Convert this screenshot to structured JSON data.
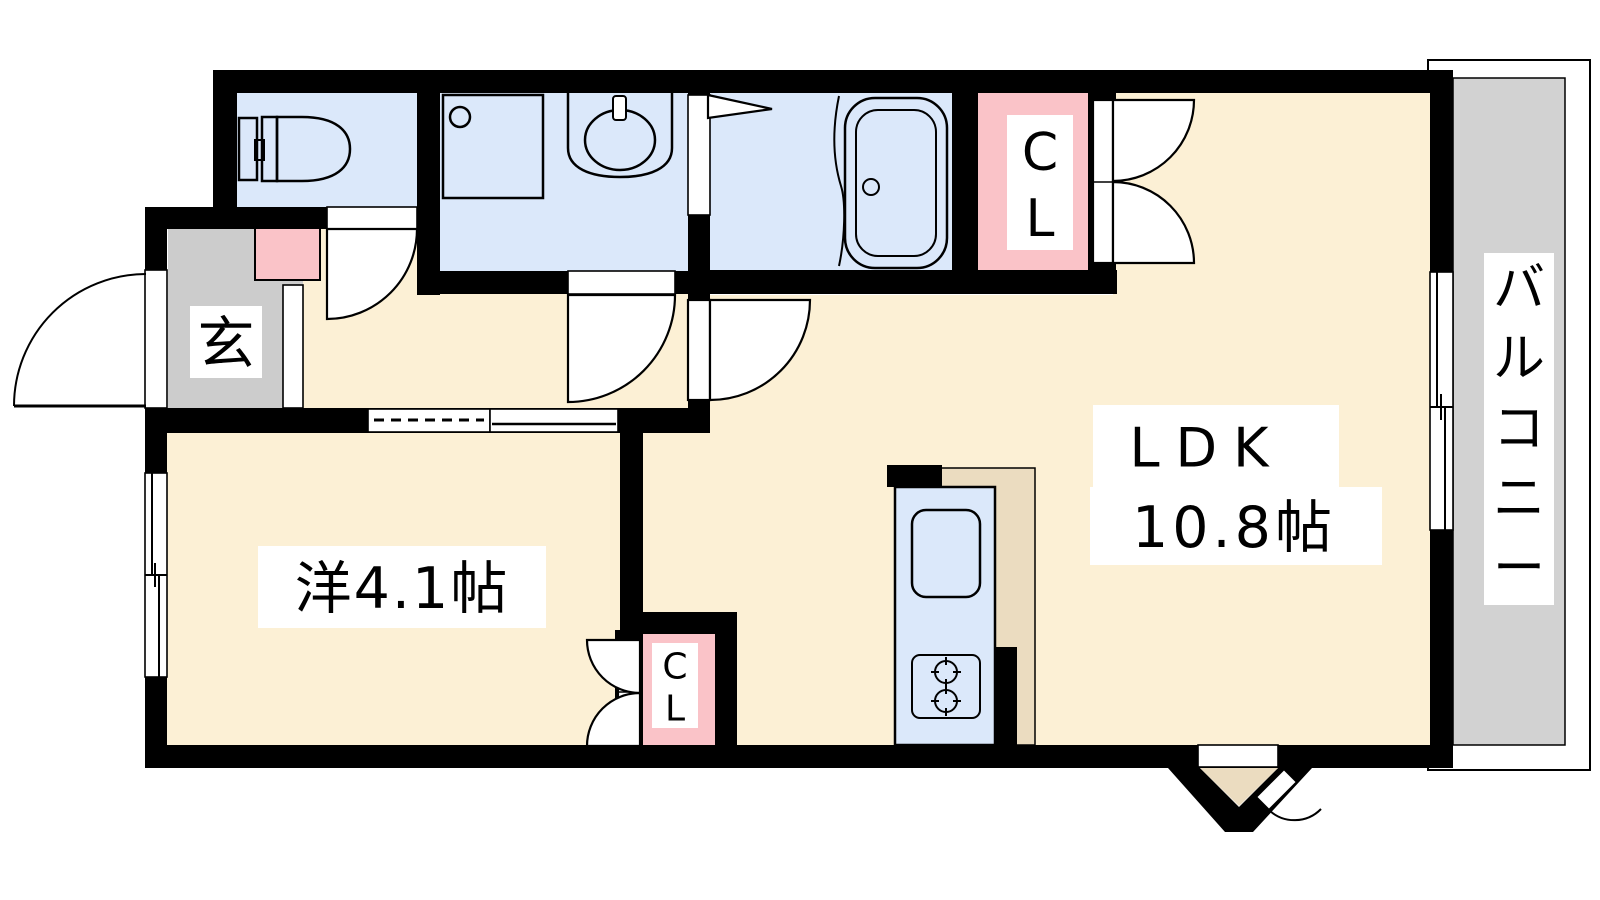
{
  "floorplan": {
    "entrance": {
      "label": "玄"
    },
    "western_room": {
      "label": "洋4.1帖"
    },
    "ldk": {
      "name": "LDK",
      "size": "10.8帖"
    },
    "closet_ldk": {
      "line1": "C",
      "line2": "L"
    },
    "closet_western": {
      "line1": "C",
      "line2": "L"
    },
    "balcony": {
      "label": "バルコニー",
      "chars": [
        "バ",
        "ル",
        "コ",
        "ニ",
        "ー"
      ]
    },
    "colors": {
      "floor": "#FCF0D5",
      "wet_area": "#DBE8FA",
      "closet": "#FAC3C8",
      "entry_floor": "#CCCCCC",
      "balcony_floor": "#D2D2D2",
      "kitchen_floor": "#EBDCC0",
      "wall": "#000000"
    }
  }
}
